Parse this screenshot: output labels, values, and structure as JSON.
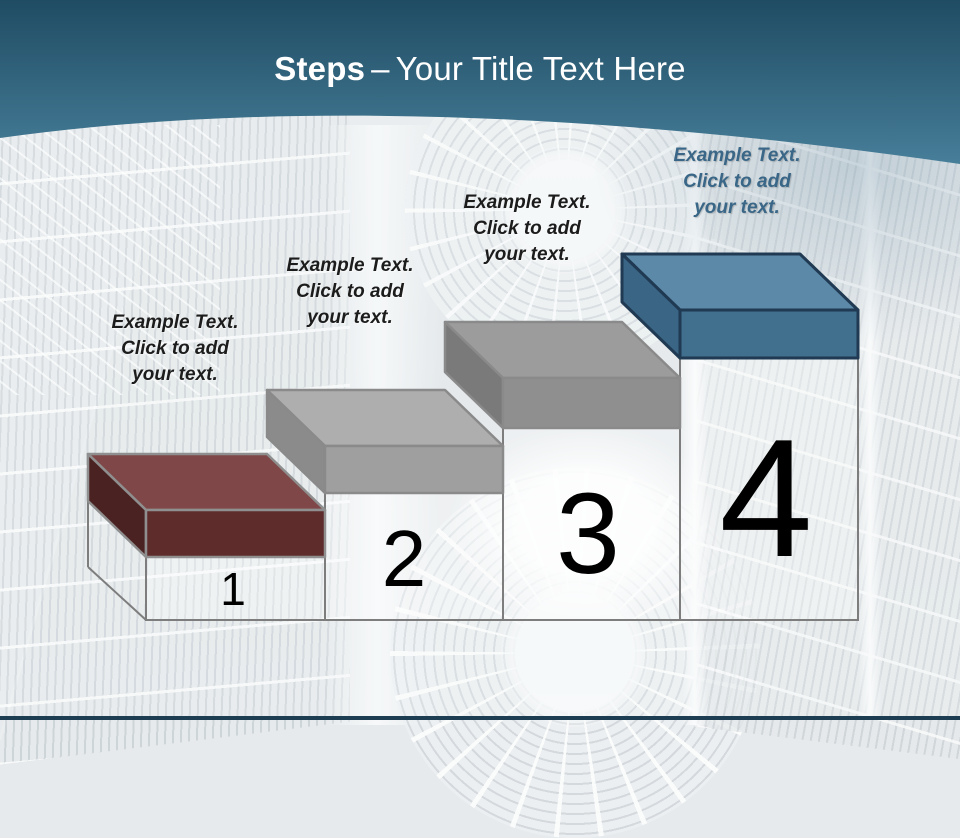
{
  "slide": {
    "title": {
      "bold": "Steps",
      "separator": "–",
      "rest": "Your Title Text Here"
    },
    "header": {
      "gradient_top": "#1f4c63",
      "gradient_bottom": "#477e99",
      "text_color": "#ffffff"
    },
    "footer_color": "#1d3d52",
    "number_color": "#000000",
    "steps": [
      {
        "number": "1",
        "label_lines": [
          "Example Text.",
          "Click  to add",
          "your text."
        ],
        "label_color": "#1c1c1c",
        "lid_top": "#7f4747",
        "lid_front": "#5f2c2c",
        "lid_side": "#4b2222",
        "outline": "#8f8f8f"
      },
      {
        "number": "2",
        "label_lines": [
          "Example Text.",
          "Click  to add",
          "your text."
        ],
        "label_color": "#1c1c1c",
        "lid_top": "#aeaeae",
        "lid_front": "#9f9f9f",
        "lid_side": "#8b8b8b",
        "outline": "#8a8a8a"
      },
      {
        "number": "3",
        "label_lines": [
          "Example Text.",
          "Click  to add",
          "your text."
        ],
        "label_color": "#1c1c1c",
        "lid_top": "#9c9c9c",
        "lid_front": "#8f8f8f",
        "lid_side": "#7a7a7a",
        "outline": "#8a8a8a"
      },
      {
        "number": "4",
        "label_lines": [
          "Example Text.",
          "Click  to add",
          "your text."
        ],
        "label_color": "#3a6787",
        "lid_top": "#5d89a8",
        "lid_front": "#416f8e",
        "lid_side": "#3a6585",
        "outline": "#1f3a52"
      }
    ]
  }
}
